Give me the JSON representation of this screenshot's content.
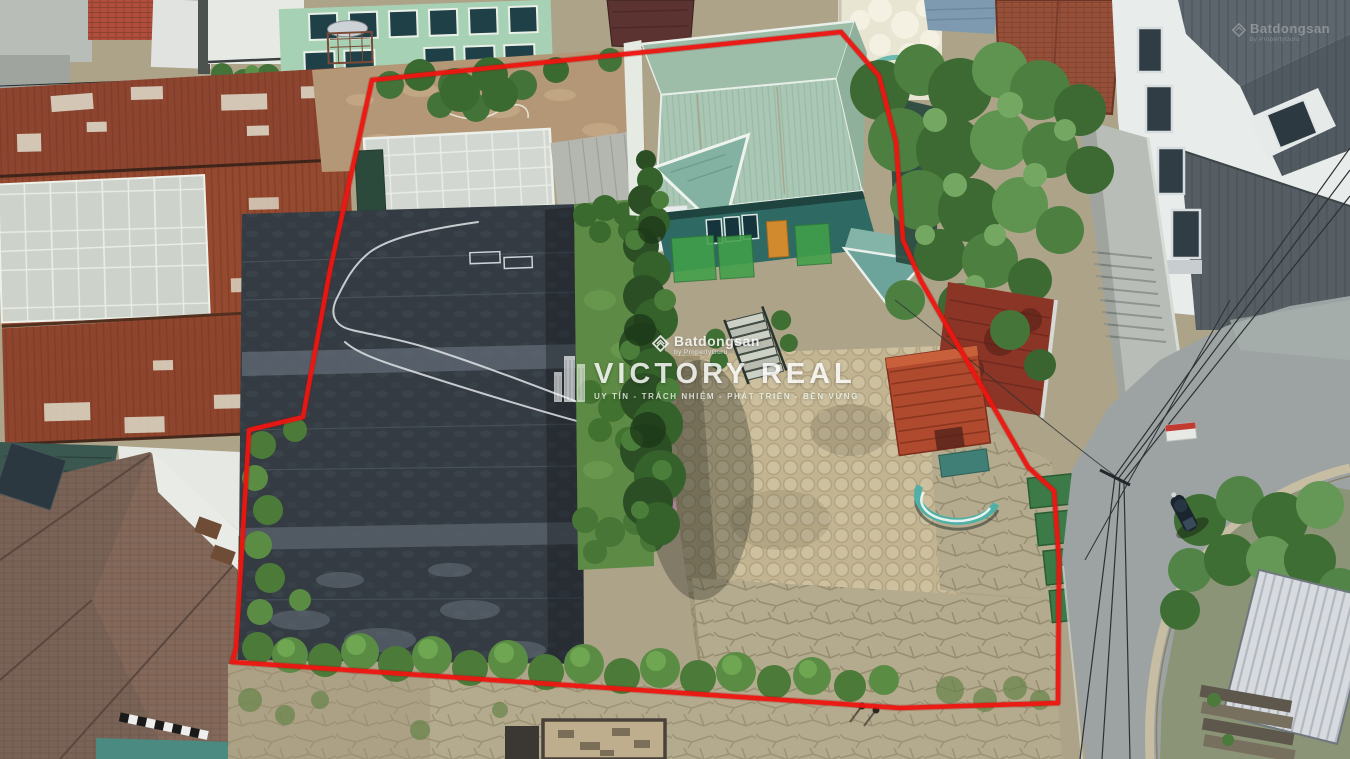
{
  "watermark_center": {
    "portal_name": "Batdongsan",
    "portal_byline": "by PropertyGuru",
    "brand_name": "VICTORY REAL",
    "tagline": "UY TÍN - TRÁCH NHIỆM - PHÁT TRIỂN - BỀN VỮNG"
  },
  "watermark_corner": {
    "portal_name": "Batdongsan",
    "portal_byline": "by PropertyGuru"
  },
  "boundary": {
    "color": "#ee1611",
    "points": "372,80 841,32 879,76 896,142 903,240 921,281 1028,467 1054,491 1059,560 1058,703 900,708 232,662 236,648 249,430 303,417 330,270"
  },
  "palette": {
    "boundary_red": "#ee1611",
    "main_house_roof": "#a9c7b4",
    "rusty_warehouse_roof": "#8e4630",
    "ground_cover_black": "#343b42",
    "courtyard_paver_tan": "#c2b491",
    "road_asphalt_gray": "#9ca3a2",
    "foliage_green": "#4a7a38",
    "mint_house_green": "#a7d1b4",
    "watermark_white": "#ffffff"
  }
}
